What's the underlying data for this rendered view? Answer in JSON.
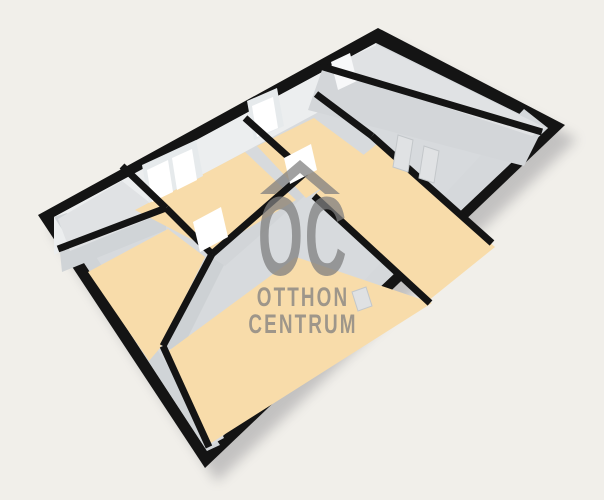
{
  "canvas": {
    "width": 604,
    "height": 500,
    "background": "#f1efea"
  },
  "palette": {
    "wall_black": "#141414",
    "floor_orange": "#f8dcaa",
    "floor_gray": "#e0e2e4",
    "interior_base_gray": "#d7dadd",
    "nw_face_gray": "#eceeef",
    "window_white": "#ffffff",
    "shadow": "#5a5a64",
    "watermark_gray": "#7f7f7f"
  },
  "watermark": {
    "oc": "OC",
    "line1": "OTTHON",
    "line2": "CENTRUM"
  },
  "scene": {
    "band_width": 7,
    "items": [
      {
        "t": "poly",
        "n": "building-shadow",
        "f": "#5a5a64",
        "o": 0.3,
        "blur": true,
        "p": [
          [
            50,
            229
          ],
          [
            390,
            42
          ],
          [
            577,
            139
          ],
          [
            217,
            482
          ]
        ]
      },
      {
        "t": "poly",
        "n": "building-outline",
        "f": "#141414",
        "p": [
          [
            38,
            215
          ],
          [
            378,
            28
          ],
          [
            565,
            125
          ],
          [
            205,
            468
          ]
        ]
      },
      {
        "t": "poly",
        "n": "interior-base",
        "f": "#d7dadd",
        "p": [
          [
            54,
            217
          ],
          [
            376,
            43
          ],
          [
            548,
            128
          ],
          [
            207,
            451
          ]
        ]
      },
      {
        "t": "poly",
        "n": "nw-wall-face",
        "f": "#eceeef",
        "p": [
          [
            54,
            217
          ],
          [
            376,
            43
          ],
          [
            376,
            81
          ],
          [
            54,
            255
          ]
        ]
      },
      {
        "t": "poly",
        "n": "sw-wall-face",
        "f": "#d0d4d7",
        "p": [
          [
            54,
            217
          ],
          [
            207,
            451
          ],
          [
            220,
            445
          ],
          [
            67,
            213
          ]
        ]
      },
      {
        "t": "poly",
        "n": "se-wall-face",
        "f": "#d5d8db",
        "p": [
          [
            548,
            128
          ],
          [
            207,
            451
          ],
          [
            213,
            443
          ],
          [
            524,
            109
          ]
        ]
      },
      {
        "t": "poly",
        "n": "ne-divider-face",
        "f": "#d3d6d9",
        "p": [
          [
            322,
            70
          ],
          [
            540,
            134
          ],
          [
            524,
            166
          ],
          [
            308,
            110
          ]
        ]
      },
      {
        "t": "poly",
        "n": "w2-wall-face",
        "f": "#d0d4d7",
        "p": [
          [
            60,
            252
          ],
          [
            166,
            211
          ],
          [
            166,
            230
          ],
          [
            62,
            272
          ]
        ]
      },
      {
        "t": "poly",
        "n": "w4-wall-face",
        "f": "#cdd1d4",
        "p": [
          [
            213,
            258
          ],
          [
            166,
            348
          ],
          [
            178,
            357
          ],
          [
            224,
            265
          ]
        ]
      },
      {
        "t": "poly",
        "n": "w5-wall-face",
        "f": "#dadcde",
        "p": [
          [
            167,
            350
          ],
          [
            211,
            445
          ],
          [
            224,
            438
          ],
          [
            180,
            346
          ]
        ]
      },
      {
        "t": "poly",
        "n": "w7-wall-face",
        "f": "#d2d5d8",
        "p": [
          [
            213,
            257
          ],
          [
            306,
            176
          ],
          [
            317,
            185
          ],
          [
            225,
            266
          ]
        ]
      },
      {
        "t": "poly",
        "n": "room-entry-floor",
        "f": "#e0e2e4",
        "p": [
          [
            58,
            219
          ],
          [
            122,
            181
          ],
          [
            163,
            213
          ],
          [
            70,
            251
          ]
        ]
      },
      {
        "t": "poly",
        "n": "room-left-floor",
        "f": "#f8dcaa",
        "p": [
          [
            135,
            210
          ],
          [
            245,
            152
          ],
          [
            296,
            200
          ],
          [
            212,
            250
          ]
        ]
      },
      {
        "t": "poly",
        "n": "room-center-floor",
        "f": "#f8dcaa",
        "p": [
          [
            257,
            146
          ],
          [
            314,
            118
          ],
          [
            368,
            158
          ],
          [
            306,
            198
          ]
        ]
      },
      {
        "t": "poly",
        "n": "room-ne-floor",
        "f": "#e0e2e4",
        "p": [
          [
            326,
            68
          ],
          [
            377,
            45
          ],
          [
            546,
            128
          ],
          [
            532,
            136
          ]
        ]
      },
      {
        "t": "poly",
        "n": "room-sw-floor",
        "f": "#f8dcaa",
        "p": [
          [
            88,
            272
          ],
          [
            168,
            229
          ],
          [
            205,
            257
          ],
          [
            160,
            348
          ],
          [
            149,
            361
          ]
        ]
      },
      {
        "t": "poly",
        "n": "room-living-floor",
        "f": "#f8dcaa",
        "p": [
          [
            314,
            195
          ],
          [
            377,
            144
          ],
          [
            495,
            247
          ],
          [
            428,
            301
          ]
        ]
      },
      {
        "t": "poly",
        "n": "room-south-floor",
        "f": "#f8dcaa",
        "p": [
          [
            163,
            355
          ],
          [
            296,
            257
          ],
          [
            432,
            303
          ],
          [
            211,
            443
          ]
        ]
      },
      {
        "t": "poly",
        "n": "window-frame-1",
        "f": "#e6eaec",
        "p": [
          [
            142,
            165
          ],
          [
            196,
            140
          ],
          [
            203,
            176
          ],
          [
            149,
            203
          ]
        ]
      },
      {
        "t": "poly",
        "n": "window-pane-1",
        "f": "#ffffff",
        "p": [
          [
            147,
            170
          ],
          [
            168,
            160
          ],
          [
            173,
            192
          ],
          [
            152,
            202
          ]
        ]
      },
      {
        "t": "poly",
        "n": "window-pane-2",
        "f": "#ffffff",
        "p": [
          [
            172,
            158
          ],
          [
            192,
            149
          ],
          [
            197,
            180
          ],
          [
            177,
            190
          ]
        ]
      },
      {
        "t": "poly",
        "n": "window-frame-2",
        "f": "#e6eaec",
        "p": [
          [
            247,
            101
          ],
          [
            277,
            88
          ],
          [
            284,
            126
          ],
          [
            254,
            140
          ]
        ]
      },
      {
        "t": "poly",
        "n": "window-pane-3",
        "f": "#ffffff",
        "p": [
          [
            252,
            106
          ],
          [
            273,
            97
          ],
          [
            278,
            128
          ],
          [
            257,
            137
          ]
        ]
      },
      {
        "t": "poly",
        "n": "window-pane-4",
        "f": "#f7f8f9",
        "p": [
          [
            331,
            62
          ],
          [
            350,
            53
          ],
          [
            357,
            81
          ],
          [
            338,
            90
          ]
        ]
      },
      {
        "t": "band",
        "n": "wall-w1",
        "a": [
          122,
          166
        ],
        "b": [
          166,
          208
        ]
      },
      {
        "t": "band",
        "n": "wall-w2",
        "a": [
          58,
          249
        ],
        "b": [
          166,
          208
        ]
      },
      {
        "t": "band",
        "n": "wall-w3",
        "a": [
          166,
          208
        ],
        "b": [
          212,
          254
        ]
      },
      {
        "t": "band",
        "n": "wall-w4",
        "a": [
          212,
          254
        ],
        "b": [
          163,
          346
        ]
      },
      {
        "t": "band",
        "n": "wall-w5",
        "a": [
          163,
          346
        ],
        "b": [
          209,
          447
        ]
      },
      {
        "t": "band",
        "n": "wall-w6",
        "a": [
          245,
          118
        ],
        "b": [
          303,
          170
        ]
      },
      {
        "t": "band",
        "n": "wall-w7",
        "a": [
          212,
          254
        ],
        "b": [
          306,
          172
        ]
      },
      {
        "t": "band",
        "n": "wall-w9",
        "a": [
          316,
          94
        ],
        "b": [
          372,
          136
        ]
      },
      {
        "t": "band",
        "n": "wall-w10",
        "a": [
          372,
          136
        ],
        "b": [
          492,
          243
        ]
      },
      {
        "t": "band",
        "n": "wall-w11",
        "a": [
          314,
          196
        ],
        "b": [
          430,
          303
        ]
      },
      {
        "t": "band",
        "n": "wall-ne-divider",
        "a": [
          320,
          66
        ],
        "b": [
          542,
          132
        ]
      },
      {
        "t": "poly",
        "n": "door-leaf-1",
        "f": "#ffffff",
        "p": [
          [
            193,
            222
          ],
          [
            221,
            207
          ],
          [
            228,
            237
          ],
          [
            200,
            252
          ]
        ]
      },
      {
        "t": "poly",
        "n": "door-leaf-2",
        "f": "#ffffff",
        "p": [
          [
            284,
            158
          ],
          [
            311,
            144
          ],
          [
            317,
            170
          ],
          [
            290,
            184
          ]
        ]
      },
      {
        "t": "poly",
        "n": "door-mark-1",
        "f": "#e0e2e4",
        "s": "#c3c7ca",
        "p": [
          [
            398,
            135
          ],
          [
            413,
            140
          ],
          [
            408,
            172
          ],
          [
            393,
            167
          ]
        ]
      },
      {
        "t": "poly",
        "n": "door-mark-2",
        "f": "#e0e2e4",
        "s": "#c3c7ca",
        "p": [
          [
            424,
            146
          ],
          [
            439,
            151
          ],
          [
            434,
            183
          ],
          [
            419,
            178
          ]
        ]
      },
      {
        "t": "poly",
        "n": "door-mark-3",
        "f": "#dfe1e3",
        "s": "#c3c7ca",
        "p": [
          [
            352,
            292
          ],
          [
            366,
            287
          ],
          [
            372,
            306
          ],
          [
            358,
            311
          ]
        ]
      }
    ]
  }
}
